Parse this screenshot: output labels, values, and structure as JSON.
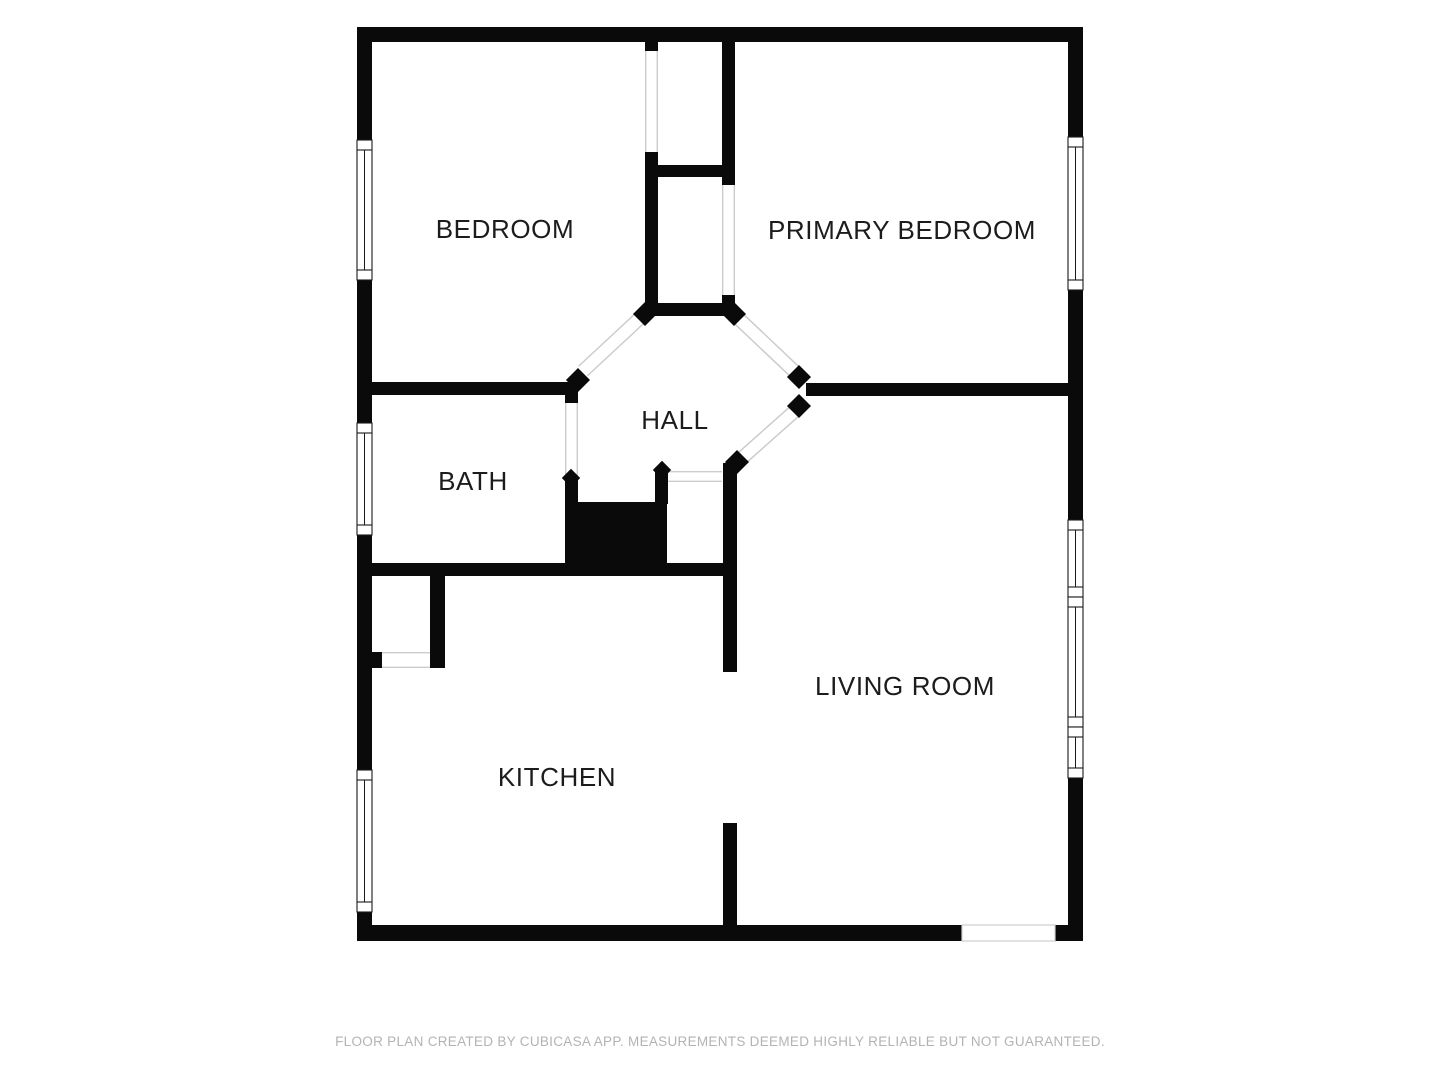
{
  "meta": {
    "app_title": "Floor plan",
    "footer": "FLOOR PLAN CREATED BY CUBICASA APP. MEASUREMENTS DEEMED HIGHLY RELIABLE BUT NOT GUARANTEED."
  },
  "style": {
    "bg": "#ffffff",
    "wall": "#0a0a0a",
    "room_fill": "#ffffff",
    "window_stroke": "#1a1a1a",
    "door_line": "#cccccc",
    "exterior_door_stroke": "#cfcfcf",
    "label_color": "#1c1c1c",
    "label_size": 26,
    "footer_color": "#b3b3b3"
  },
  "rooms": [
    {
      "id": "bedroom",
      "label": "BEDROOM",
      "x": 505,
      "y": 229
    },
    {
      "id": "primary-bedroom",
      "label": "PRIMARY BEDROOM",
      "x": 902,
      "y": 230
    },
    {
      "id": "hall",
      "label": "HALL",
      "x": 675,
      "y": 420
    },
    {
      "id": "bath",
      "label": "BATH",
      "x": 473,
      "y": 481
    },
    {
      "id": "living-room",
      "label": "LIVING ROOM",
      "x": 905,
      "y": 686
    },
    {
      "id": "kitchen",
      "label": "KITCHEN",
      "x": 557,
      "y": 777
    }
  ],
  "walls": [
    [
      357,
      27,
      726,
      15
    ],
    [
      357,
      925,
      605,
      16
    ],
    [
      1055,
      925,
      28,
      16
    ],
    [
      357,
      27,
      15,
      113
    ],
    [
      357,
      280,
      15,
      143
    ],
    [
      357,
      535,
      15,
      235
    ],
    [
      357,
      912,
      15,
      29
    ],
    [
      1068,
      27,
      15,
      110
    ],
    [
      1068,
      290,
      15,
      230
    ],
    [
      1068,
      778,
      15,
      163
    ],
    [
      645,
      42,
      13,
      9
    ],
    [
      645,
      152,
      13,
      151
    ],
    [
      722,
      42,
      13,
      143
    ],
    [
      722,
      295,
      13,
      9
    ],
    [
      650,
      165,
      72,
      12
    ],
    [
      645,
      303,
      90,
      13
    ],
    [
      357,
      382,
      221,
      13
    ],
    [
      565,
      382,
      13,
      21
    ],
    [
      565,
      477,
      13,
      27
    ],
    [
      806,
      383,
      262,
      13
    ],
    [
      655,
      470,
      13,
      34
    ],
    [
      723,
      463,
      14,
      209
    ],
    [
      723,
      823,
      14,
      104
    ],
    [
      357,
      563,
      380,
      13
    ],
    [
      565,
      502,
      102,
      73
    ],
    [
      430,
      575,
      15,
      93
    ],
    [
      372,
      652,
      10,
      16
    ]
  ],
  "diamonds": [
    [
      645,
      314,
      17
    ],
    [
      734,
      314,
      17
    ],
    [
      578,
      380,
      17
    ],
    [
      799,
      377,
      17
    ],
    [
      799,
      406,
      17
    ],
    [
      737,
      462,
      17
    ],
    [
      662,
      470,
      13
    ],
    [
      571,
      478,
      13
    ]
  ],
  "diagonal_doors": [
    {
      "id": "bedroom-door",
      "x1": 640,
      "y1": 318,
      "x2": 583,
      "y2": 371,
      "width": 13
    },
    {
      "id": "primary-bedroom-door",
      "x1": 738,
      "y1": 318,
      "x2": 794,
      "y2": 371,
      "width": 13
    },
    {
      "id": "living-room-door",
      "x1": 796,
      "y1": 410,
      "x2": 742,
      "y2": 458,
      "width": 13
    }
  ],
  "straight_doors": [
    {
      "id": "bedroom-closet-door",
      "x": 645,
      "y": 51,
      "w": 13,
      "h": 101
    },
    {
      "id": "primary-bedroom-closet-door",
      "x": 722,
      "y": 185,
      "w": 13,
      "h": 110
    },
    {
      "id": "bath-door",
      "x": 565,
      "y": 403,
      "w": 13,
      "h": 74
    },
    {
      "id": "hall-closet-door",
      "x": 668,
      "y": 471,
      "w": 54,
      "h": 11
    },
    {
      "id": "kitchen-closet-door",
      "x": 382,
      "y": 652,
      "w": 48,
      "h": 16
    }
  ],
  "exterior_door": {
    "id": "entry-opening",
    "x": 962,
    "y": 925,
    "w": 93,
    "h": 16
  },
  "windows": [
    {
      "id": "bedroom-window",
      "x": 357,
      "y": 140,
      "w": 15,
      "h": 140
    },
    {
      "id": "bath-window",
      "x": 357,
      "y": 423,
      "w": 15,
      "h": 112
    },
    {
      "id": "kitchen-window",
      "x": 357,
      "y": 770,
      "w": 15,
      "h": 142
    },
    {
      "id": "primary-bedroom-window",
      "x": 1068,
      "y": 137,
      "w": 15,
      "h": 153
    },
    {
      "id": "living-room-window-1",
      "x": 1068,
      "y": 520,
      "w": 15,
      "h": 77
    },
    {
      "id": "living-room-window-2",
      "x": 1068,
      "y": 597,
      "w": 15,
      "h": 130
    },
    {
      "id": "living-room-window-3",
      "x": 1068,
      "y": 727,
      "w": 15,
      "h": 51
    }
  ]
}
